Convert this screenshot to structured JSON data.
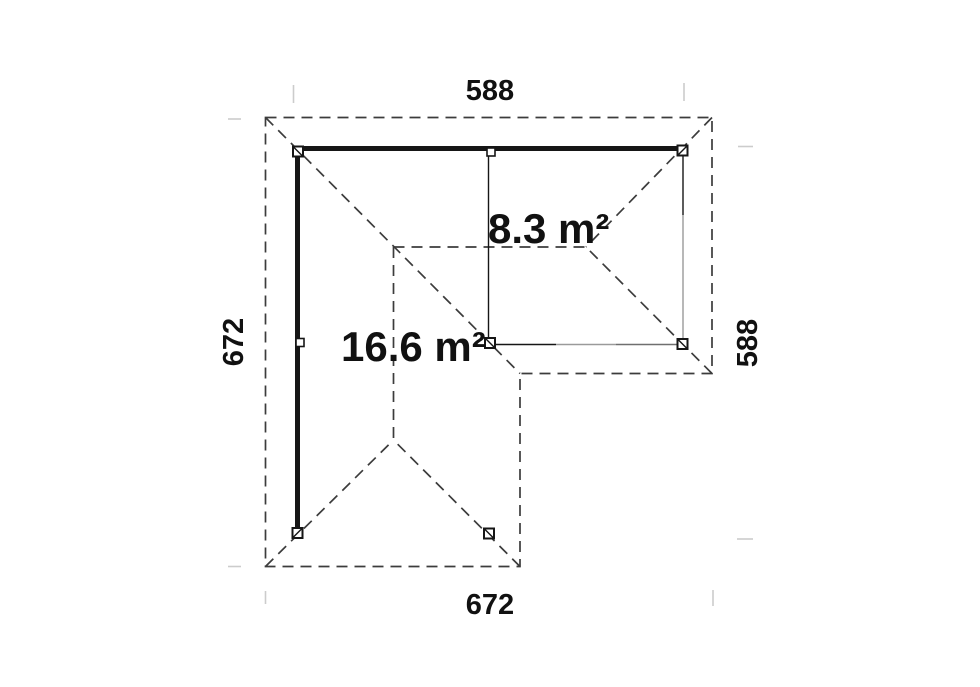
{
  "plan": {
    "dimensions": {
      "top": "588",
      "bottom": "672",
      "left": "672",
      "right": "588"
    },
    "areas": {
      "annex_room": "8.3 m²",
      "main_room": "16.6 m²"
    },
    "colors": {
      "background": "#ffffff",
      "solid_line": "#161616",
      "dashed_line": "#3c3c3c",
      "hidden_line": "#9a9a9a",
      "room_edge": "#6f6f6f",
      "tick": "#cccccc",
      "text": "#111111"
    }
  }
}
